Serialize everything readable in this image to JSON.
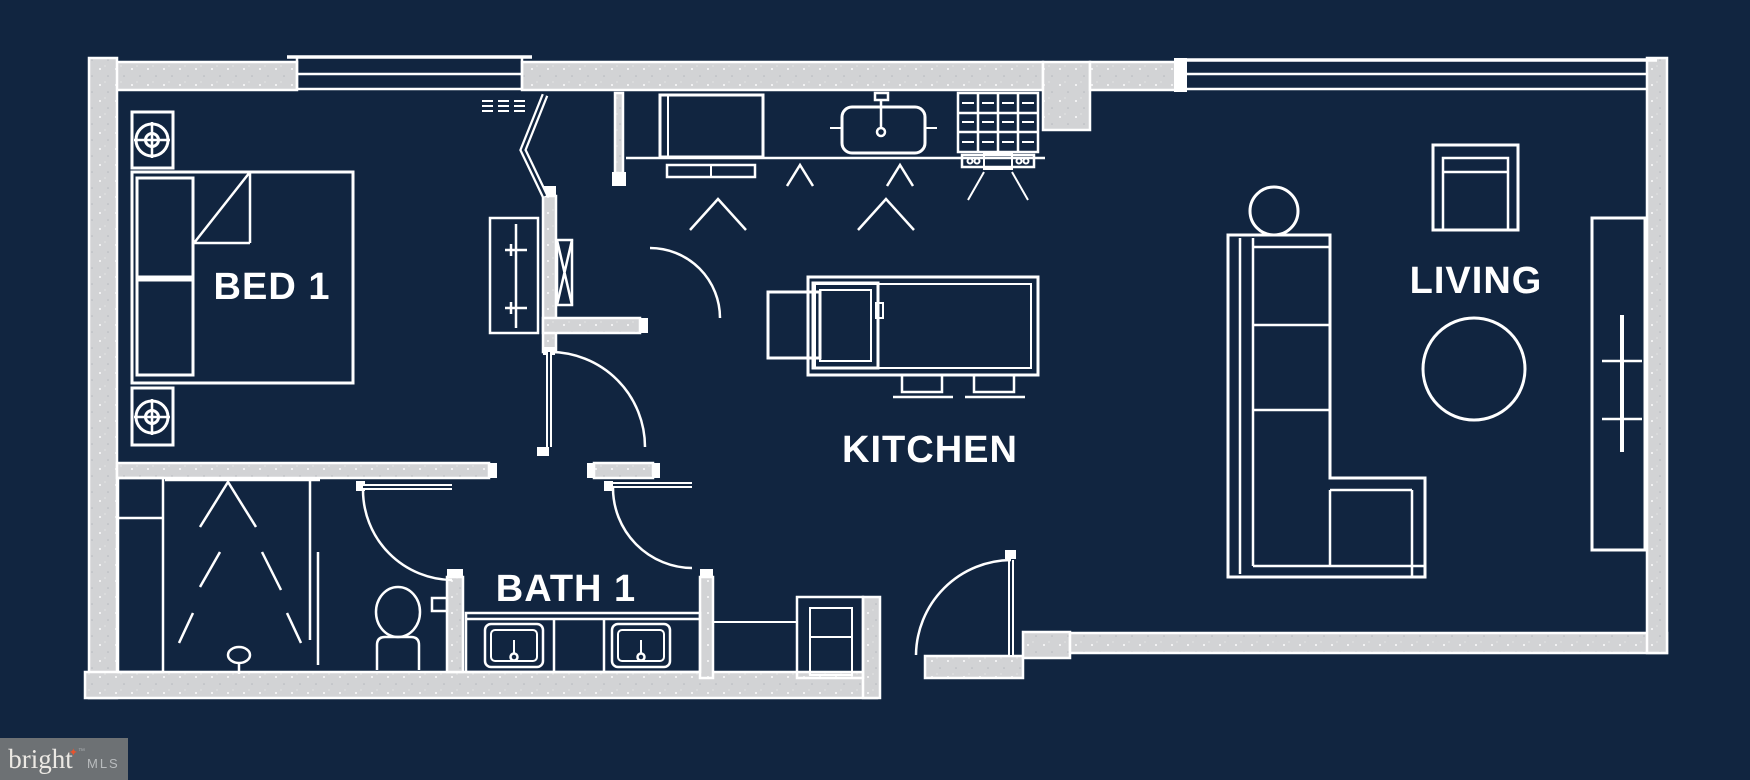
{
  "plan": {
    "type": "apartment-floor-plan",
    "rooms": [
      {
        "id": "bed-1",
        "label": "BED 1"
      },
      {
        "id": "bath-1",
        "label": "BATH 1"
      },
      {
        "id": "kitchen",
        "label": "KITCHEN"
      },
      {
        "id": "living",
        "label": "LIVING"
      }
    ],
    "fixtures": [
      "queen-bed",
      "pillows",
      "sheet-fold",
      "nightstand-lamp-top",
      "nightstand-lamp-bottom",
      "wardrobe-closet-with-rod",
      "bifold-door",
      "hvac-vent-grille",
      "duct-chase",
      "bedroom-door",
      "hall-door",
      "bath-door-left",
      "bath-door-right",
      "entry-door",
      "linen-cabinet",
      "walk-in-shower",
      "shower-drain",
      "toilet",
      "double-vanity-two-sinks",
      "refrigerator",
      "kitchen-sink-with-faucet",
      "gas-range",
      "kitchen-island",
      "island-sink",
      "island-end-chair",
      "bar-stool-1",
      "bar-stool-2",
      "utility-closet",
      "sectional-sofa",
      "round-side-table",
      "armchair",
      "round-coffee-table",
      "tv-console",
      "wall-tv",
      "bedroom-window",
      "living-room-window",
      "side-window-wall"
    ]
  },
  "palette": {
    "background": "#112540",
    "line": "#ffffff",
    "wall": "#d2d3d5",
    "watermark_bg": "#6d7174",
    "watermark_brand": "#ece9e4",
    "watermark_star": "#e8542e",
    "watermark_org": "#b9bcbe"
  },
  "watermark": {
    "brand": "bright",
    "star": "✦",
    "trademark": "™",
    "org": "MLS"
  }
}
